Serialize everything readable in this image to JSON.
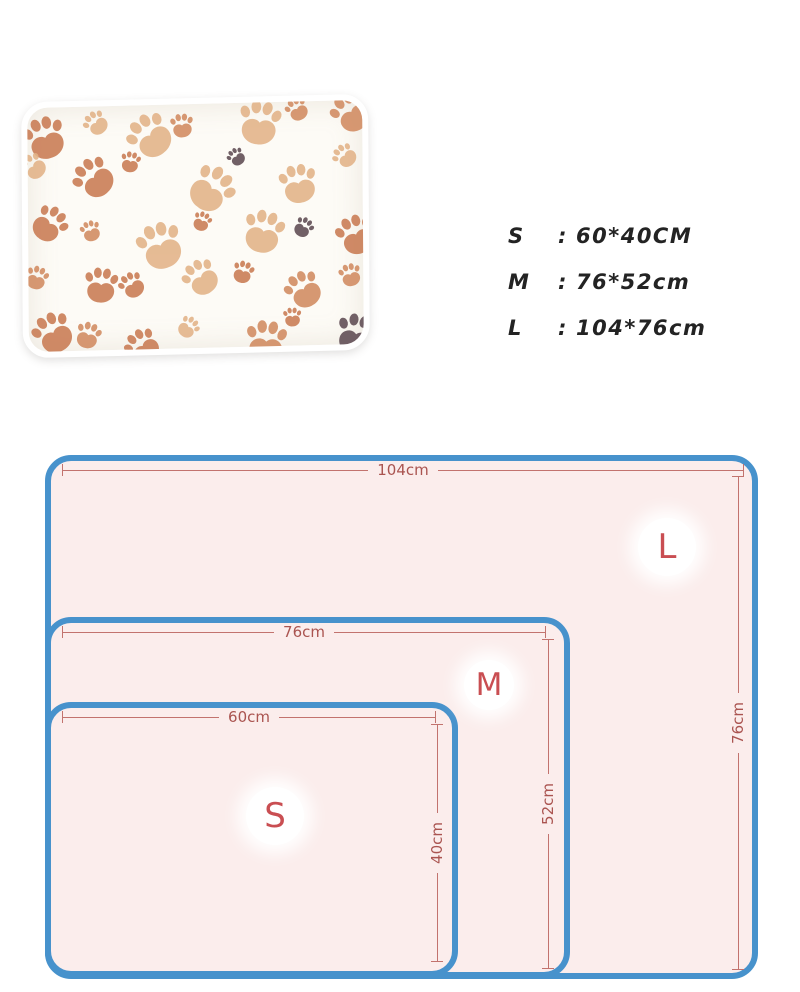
{
  "product": {
    "name": "paw print pet blanket",
    "photo": {
      "blanket_color": "#fdfbf6",
      "paw_colors": [
        "#5e4a52",
        "#c97a52",
        "#e2b287",
        "#d18a60"
      ]
    }
  },
  "size_list": {
    "items": [
      {
        "label": "S",
        "separator": ":",
        "value": "60*40CM"
      },
      {
        "label": "M",
        "separator": ":",
        "value": "76*52cm"
      },
      {
        "label": "L",
        "separator": ":",
        "value": "104*76cm"
      }
    ],
    "text_color": "#232323"
  },
  "diagram": {
    "type": "nested-size-diagram",
    "colors": {
      "border": "#4792cc",
      "fill": "#fbedec",
      "dimension_line": "#c2736e",
      "dimension_text": "#aa5450",
      "size_letter": "#c94e52"
    },
    "sizes": [
      {
        "label": "L",
        "width_label": "104cm",
        "height_label": "76cm",
        "width_cm": 104,
        "height_cm": 76
      },
      {
        "label": "M",
        "width_label": "76cm",
        "height_label": "52cm",
        "width_cm": 76,
        "height_cm": 52
      },
      {
        "label": "S",
        "width_label": "60cm",
        "height_label": "40cm",
        "width_cm": 60,
        "height_cm": 40
      }
    ]
  }
}
